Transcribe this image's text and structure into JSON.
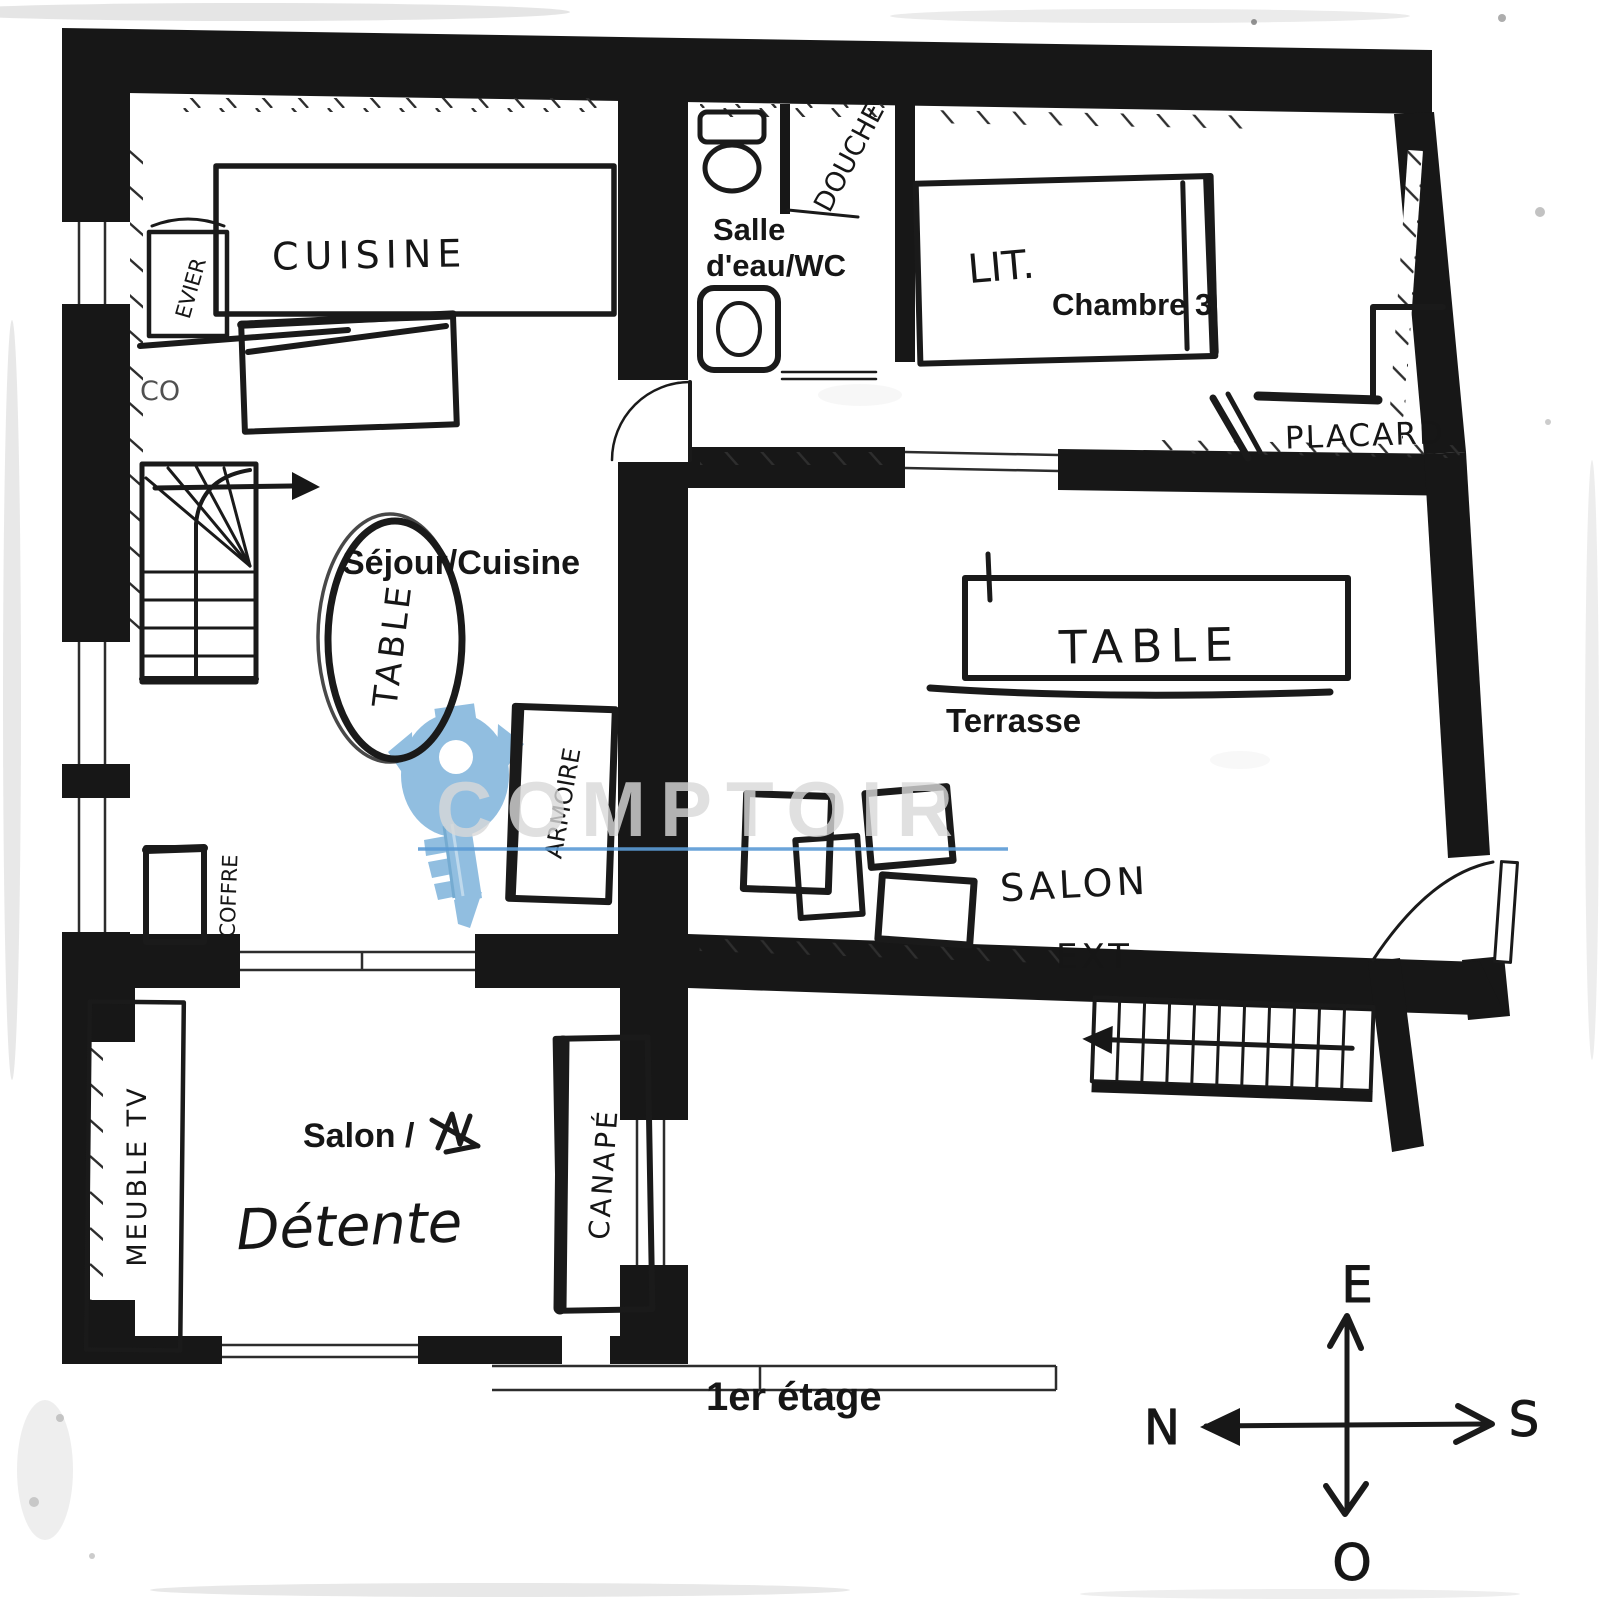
{
  "floor": {
    "title": "1er étage"
  },
  "rooms": {
    "cuisine": "CUISINE",
    "salle_eau_1": "Salle",
    "salle_eau_2": "d'eau/WC",
    "douche": "DOUCHE",
    "chambre": "Chambre 3",
    "sejour": "Séjour/Cuisine",
    "terrasse": "Terrasse",
    "salon": "Salon /",
    "detente": "Détente",
    "salon_ext_1": "SALON",
    "salon_ext_2": "EXT"
  },
  "furniture": {
    "lit": "LIT.",
    "placard": "PLACARD",
    "table_sejour": "TABLE",
    "table_terrasse": "TABLE",
    "armoire": "ARMOIRE",
    "coffre": "COFFRE",
    "evier": "EVIER",
    "co": "CO",
    "meuble_tv": "MEUBLE TV",
    "canape": "CANAPÉ"
  },
  "compass": {
    "top": "E",
    "left": "N",
    "right": "S",
    "bottom": "O"
  },
  "watermark": {
    "text": "COMPTOIR"
  },
  "colors": {
    "ink": "#171717",
    "key_blue": "#8cbbdf",
    "line_blue": "#5b9bd5"
  }
}
